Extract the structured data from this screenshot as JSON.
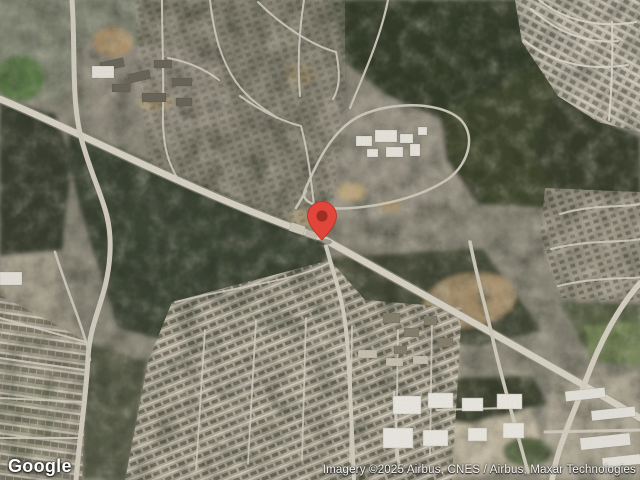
{
  "map": {
    "view": "satellite",
    "size": {
      "width": 640,
      "height": 480
    },
    "marker": {
      "name": "red-location-pin",
      "color": "#E2453A",
      "inner_color": "#9E2F23",
      "stroke_color": "#B23228",
      "tip_x": 322,
      "tip_y": 240
    },
    "palette": {
      "terrain": "#8F8B7D",
      "forest": "#3C4232",
      "wooded_suburb": "#7A7767",
      "suburb_light": "#B6B0A2",
      "road": "#DCD7C9",
      "dirt": "#AC9470",
      "grass": "#647E4D",
      "building_white": "#EFEDE6"
    }
  },
  "branding": {
    "logo_text": "Google"
  },
  "attribution": {
    "text": "Imagery ©2025 Airbus, CNES / Airbus, Maxar Technologies"
  }
}
